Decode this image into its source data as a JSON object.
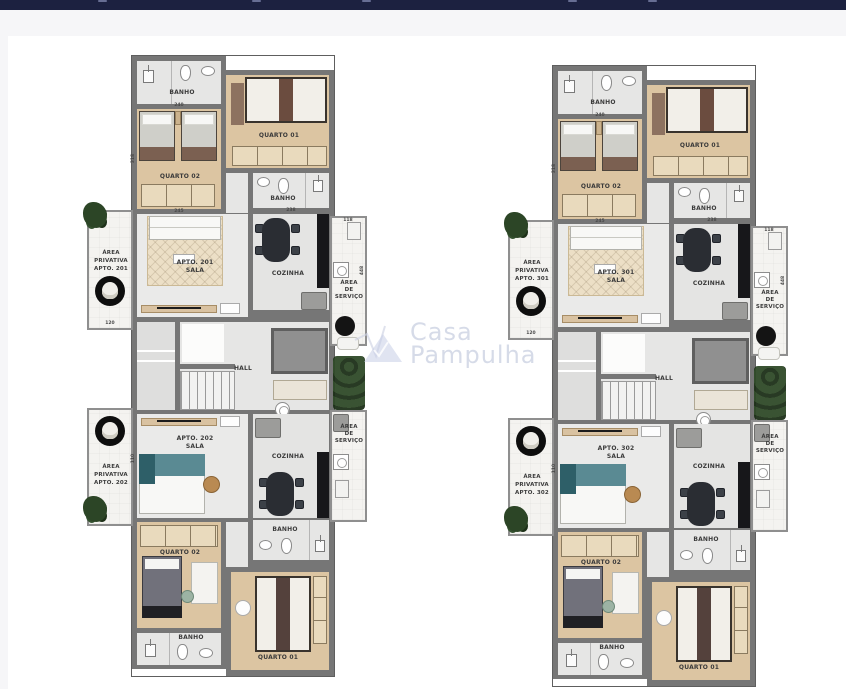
{
  "page": {
    "top_bar_color": "#1c2140",
    "canvas_bg": "#ffffff"
  },
  "watermark": {
    "line1": "Casa",
    "line2": "Pampulha"
  },
  "dimensions": [
    "240",
    "245",
    "318",
    "110",
    "238",
    "118",
    "448",
    "120"
  ],
  "plans": [
    {
      "name": "floor-apartments-201-202",
      "rooms": {
        "banho_top": "BANHO",
        "quarto1_top": "QUARTO 01",
        "quarto2_top": "QUARTO 02",
        "banho_mid_top": "BANHO",
        "priv1_l1": "ÁREA",
        "priv1_l2": "PRIVATIVA",
        "priv1_l3": "APTO. 201",
        "sala1_l1": "APTO. 201",
        "sala1_l2": "SALA",
        "cozinha_top": "COZINHA",
        "serv1_l1": "ÁREA",
        "serv1_l2": "DE",
        "serv1_l3": "SERVIÇO",
        "hall": "HALL",
        "sala2_l1": "APTO. 202",
        "sala2_l2": "SALA",
        "cozinha_bot": "COZINHA",
        "serv2_l1": "ÁREA",
        "serv2_l2": "DE",
        "serv2_l3": "SERVIÇO",
        "priv2_l1": "ÁREA",
        "priv2_l2": "PRIVATIVA",
        "priv2_l3": "APTO. 202",
        "banho_mid_bot": "BANHO",
        "quarto2_bot": "QUARTO 02",
        "quarto1_bot": "QUARTO 01",
        "banho_bot": "BANHO"
      }
    },
    {
      "name": "floor-apartments-301-302",
      "rooms": {
        "banho_top": "BANHO",
        "quarto1_top": "QUARTO 01",
        "quarto2_top": "QUARTO 02",
        "banho_mid_top": "BANHO",
        "priv1_l1": "ÁREA",
        "priv1_l2": "PRIVATIVA",
        "priv1_l3": "APTO. 301",
        "sala1_l1": "APTO. 301",
        "sala1_l2": "SALA",
        "cozinha_top": "COZINHA",
        "serv1_l1": "ÁREA",
        "serv1_l2": "DE",
        "serv1_l3": "SERVIÇO",
        "hall": "HALL",
        "sala2_l1": "APTO. 302",
        "sala2_l2": "SALA",
        "cozinha_bot": "COZINHA",
        "serv2_l1": "ÁREA",
        "serv2_l2": "DE",
        "serv2_l3": "SERVIÇO",
        "priv2_l1": "ÁREA",
        "priv2_l2": "PRIVATIVA",
        "priv2_l3": "APTO. 302",
        "banho_mid_bot": "BANHO",
        "quarto2_bot": "QUARTO 02",
        "quarto1_bot": "QUARTO 01",
        "banho_bot": "BANHO"
      }
    }
  ]
}
